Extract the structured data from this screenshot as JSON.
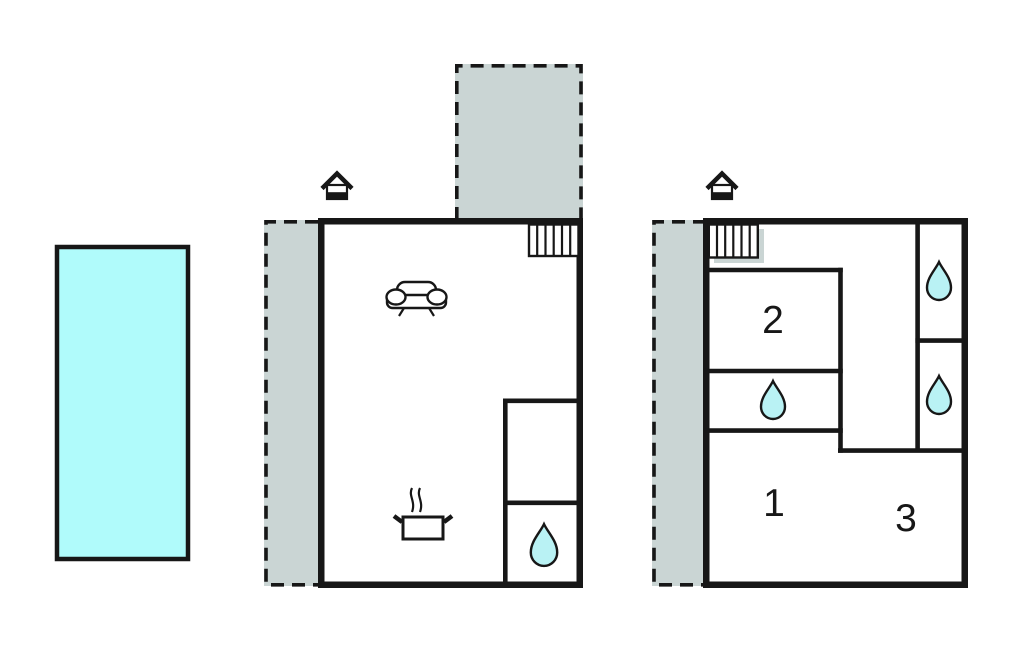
{
  "colors": {
    "wall": "#171717",
    "terrace": "#cad5d4",
    "pool": "#b0fbfb",
    "water": "#b9f2f4",
    "room": "#ffffff"
  },
  "pool": {
    "type": "swimming-pool"
  },
  "floors": [
    {
      "id": "ground-floor",
      "room_labels": [],
      "features": [
        "entrance-house-icon",
        "stairs-icon",
        "terrace-left",
        "terrace-top",
        "sofa-icon",
        "cooking-pot-icon",
        "water-drop-icon"
      ]
    },
    {
      "id": "first-floor",
      "room_labels": [
        "1",
        "2",
        "3"
      ],
      "features": [
        "entrance-house-icon",
        "stairs-icon",
        "terrace-left",
        "water-drop-icon",
        "water-drop-icon",
        "water-drop-icon"
      ]
    }
  ]
}
